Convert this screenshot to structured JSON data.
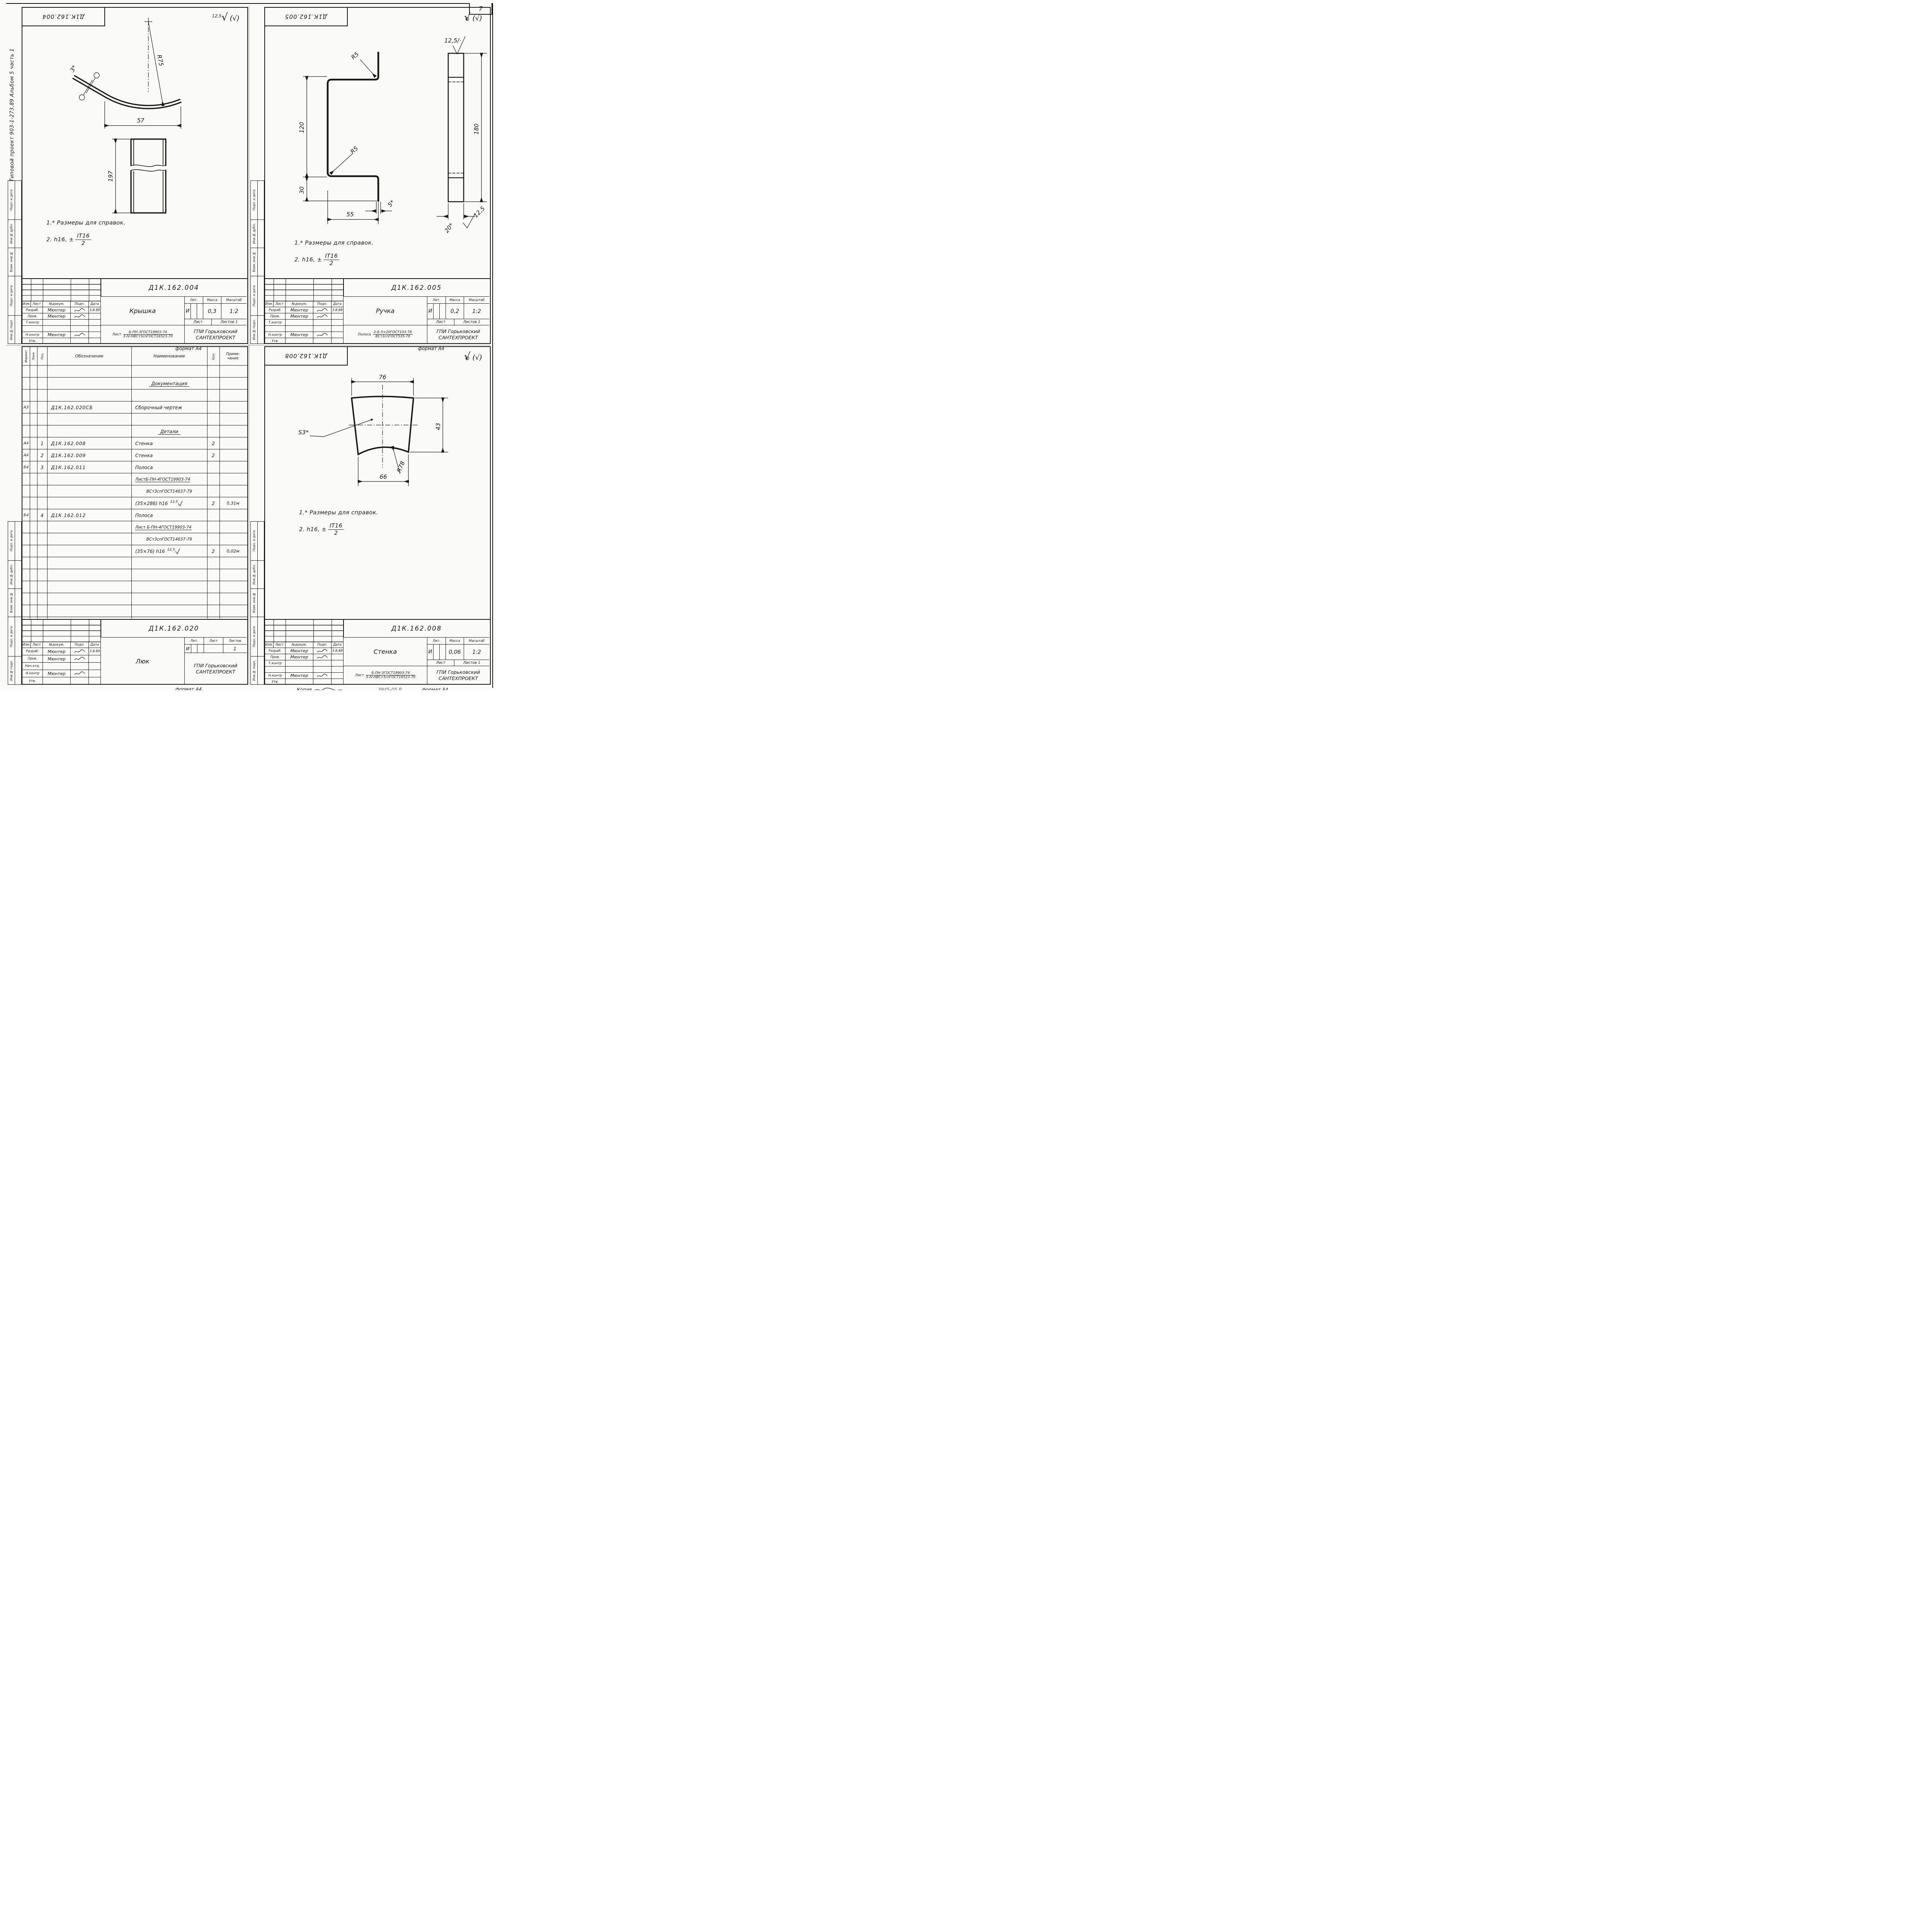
{
  "page": {
    "number": "7"
  },
  "edge_note": "Типовой проект 903-1-273,89 Альбом 5 часть 1",
  "margins": {
    "m0": "Подп. и дата",
    "m1": "Инв.№ дубл.",
    "m2": "Взам. инв.№",
    "m3": "Подп. и дата",
    "m4": "Инв.№ подл."
  },
  "notes": {
    "l1": "1.* Размеры для справок.",
    "l2": "2. h16, ±",
    "num": "IT16",
    "den": "2"
  },
  "fin": {
    "ra": "12,5",
    "check": "√",
    "paren": "(√)",
    "top": "12,5/·",
    "bot": "12,5"
  },
  "tb": {
    "izm": "Изм.",
    "list": "Лист",
    "dokum": "№докум.",
    "podp": "Подп.",
    "data": "Дата",
    "razrab": "Разраб.",
    "prov": "Пров.",
    "tkontr": "Т.контр",
    "nachotd": "Нач.отд.",
    "nkontr": "Н.контр",
    "utv": "Утв.",
    "lit": "Лит.",
    "massa": "Масса",
    "masshtab": "Масштаб",
    "list2": "Лист",
    "listov": "Листов",
    "listov1": "Листов 1",
    "author": "Мюнтер",
    "date": "3.8.89",
    "org1": "ГПИ Горьковский",
    "org2": "САНТЕХПРОЕКТ",
    "format": "формат А4",
    "mat_list": "Лист",
    "mat_polosa": "Полоса"
  },
  "tl": {
    "stamp": "Д1К.162.004",
    "designation": "Д1К.162.004",
    "title": "Крышка",
    "lit": "И",
    "mass": "0,3",
    "scale": "1:2",
    "mat_num": "Б-ПН-3ГОСТ19903-74",
    "mat_den": "3-IV-НВСт3спГОСТ16523-70",
    "r": "R75",
    "t": "3*",
    "w": "57",
    "h": "197"
  },
  "tr": {
    "stamp": "Д1К.162.005",
    "designation": "Д1К.162.005",
    "title": "Ручка",
    "lit": "И",
    "mass": "0,2",
    "scale": "1:2",
    "mat_num": "2-Б-5×20ГОСТ103-76",
    "mat_den": "ВСт3спГОСТ535-79",
    "h1": "120",
    "h2": "30",
    "w": "55",
    "t": "5*",
    "r1": "R5",
    "r2": "R5",
    "len": "180",
    "wd": "20*"
  },
  "bl": {
    "designation": "Д1К.162.020",
    "title": "Люк",
    "lit": "И",
    "listov_val": "1",
    "cols": {
      "f": "Формат",
      "z": "Зона",
      "p": "Поз.",
      "d": "Обозначение",
      "n": "Наименование",
      "q": "Кол.",
      "note1": "Приме-",
      "note2": "чание"
    },
    "rows": {
      "r1": {
        "n": "Документация"
      },
      "r3": {
        "f": "А3",
        "d": "Д1К.162.020СБ",
        "n": "Сборочный чертеж"
      },
      "r5": {
        "n": "Детали"
      },
      "r6": {
        "f": "А4",
        "p": "1",
        "d": "Д1К.162.008",
        "n": "Стенка",
        "q": "2"
      },
      "r7": {
        "f": "А4",
        "p": "2",
        "d": "Д1К.162.009",
        "n": "Стенка",
        "q": "2"
      },
      "r8": {
        "f": "Б4",
        "p": "3",
        "d": "Д1К.162.011",
        "n": "Полоса"
      },
      "r9": {
        "n": "ЛистБ-ПН-4ГОСТ19903-74"
      },
      "r10": {
        "n": "ВСт3спГОСТ14637-79"
      },
      "r11": {
        "n": "(35×286) h16",
        "fin": "12,5",
        "q": "2",
        "note": "0,31м"
      },
      "r12": {
        "f": "Б4",
        "p": "4",
        "d": "Д1К.162.012",
        "n": "Полоса"
      },
      "r13": {
        "n": "Лист Б-ПН-4ГОСТ19903-74"
      },
      "r14": {
        "n": "ВСт3спГОСТ14637-79"
      },
      "r15": {
        "n": "(35×76) h16",
        "fin": "12,5",
        "q": "2",
        "note": "0,02м"
      }
    }
  },
  "br": {
    "stamp": "Д1К.162.008",
    "designation": "Д1К.162.008",
    "title": "Стенка",
    "lit": "И",
    "mass": "0,06",
    "scale": "1:2",
    "mat_num": "Б-ПН-3ГОСТ19903-74",
    "mat_den": "3-IV-НВСт3спГОСТ16523-70",
    "top": "76",
    "side": "43",
    "bot": "66",
    "r": "R78",
    "s": "S3*",
    "copy": "Копия",
    "copy_num": "3945-05 Р"
  }
}
